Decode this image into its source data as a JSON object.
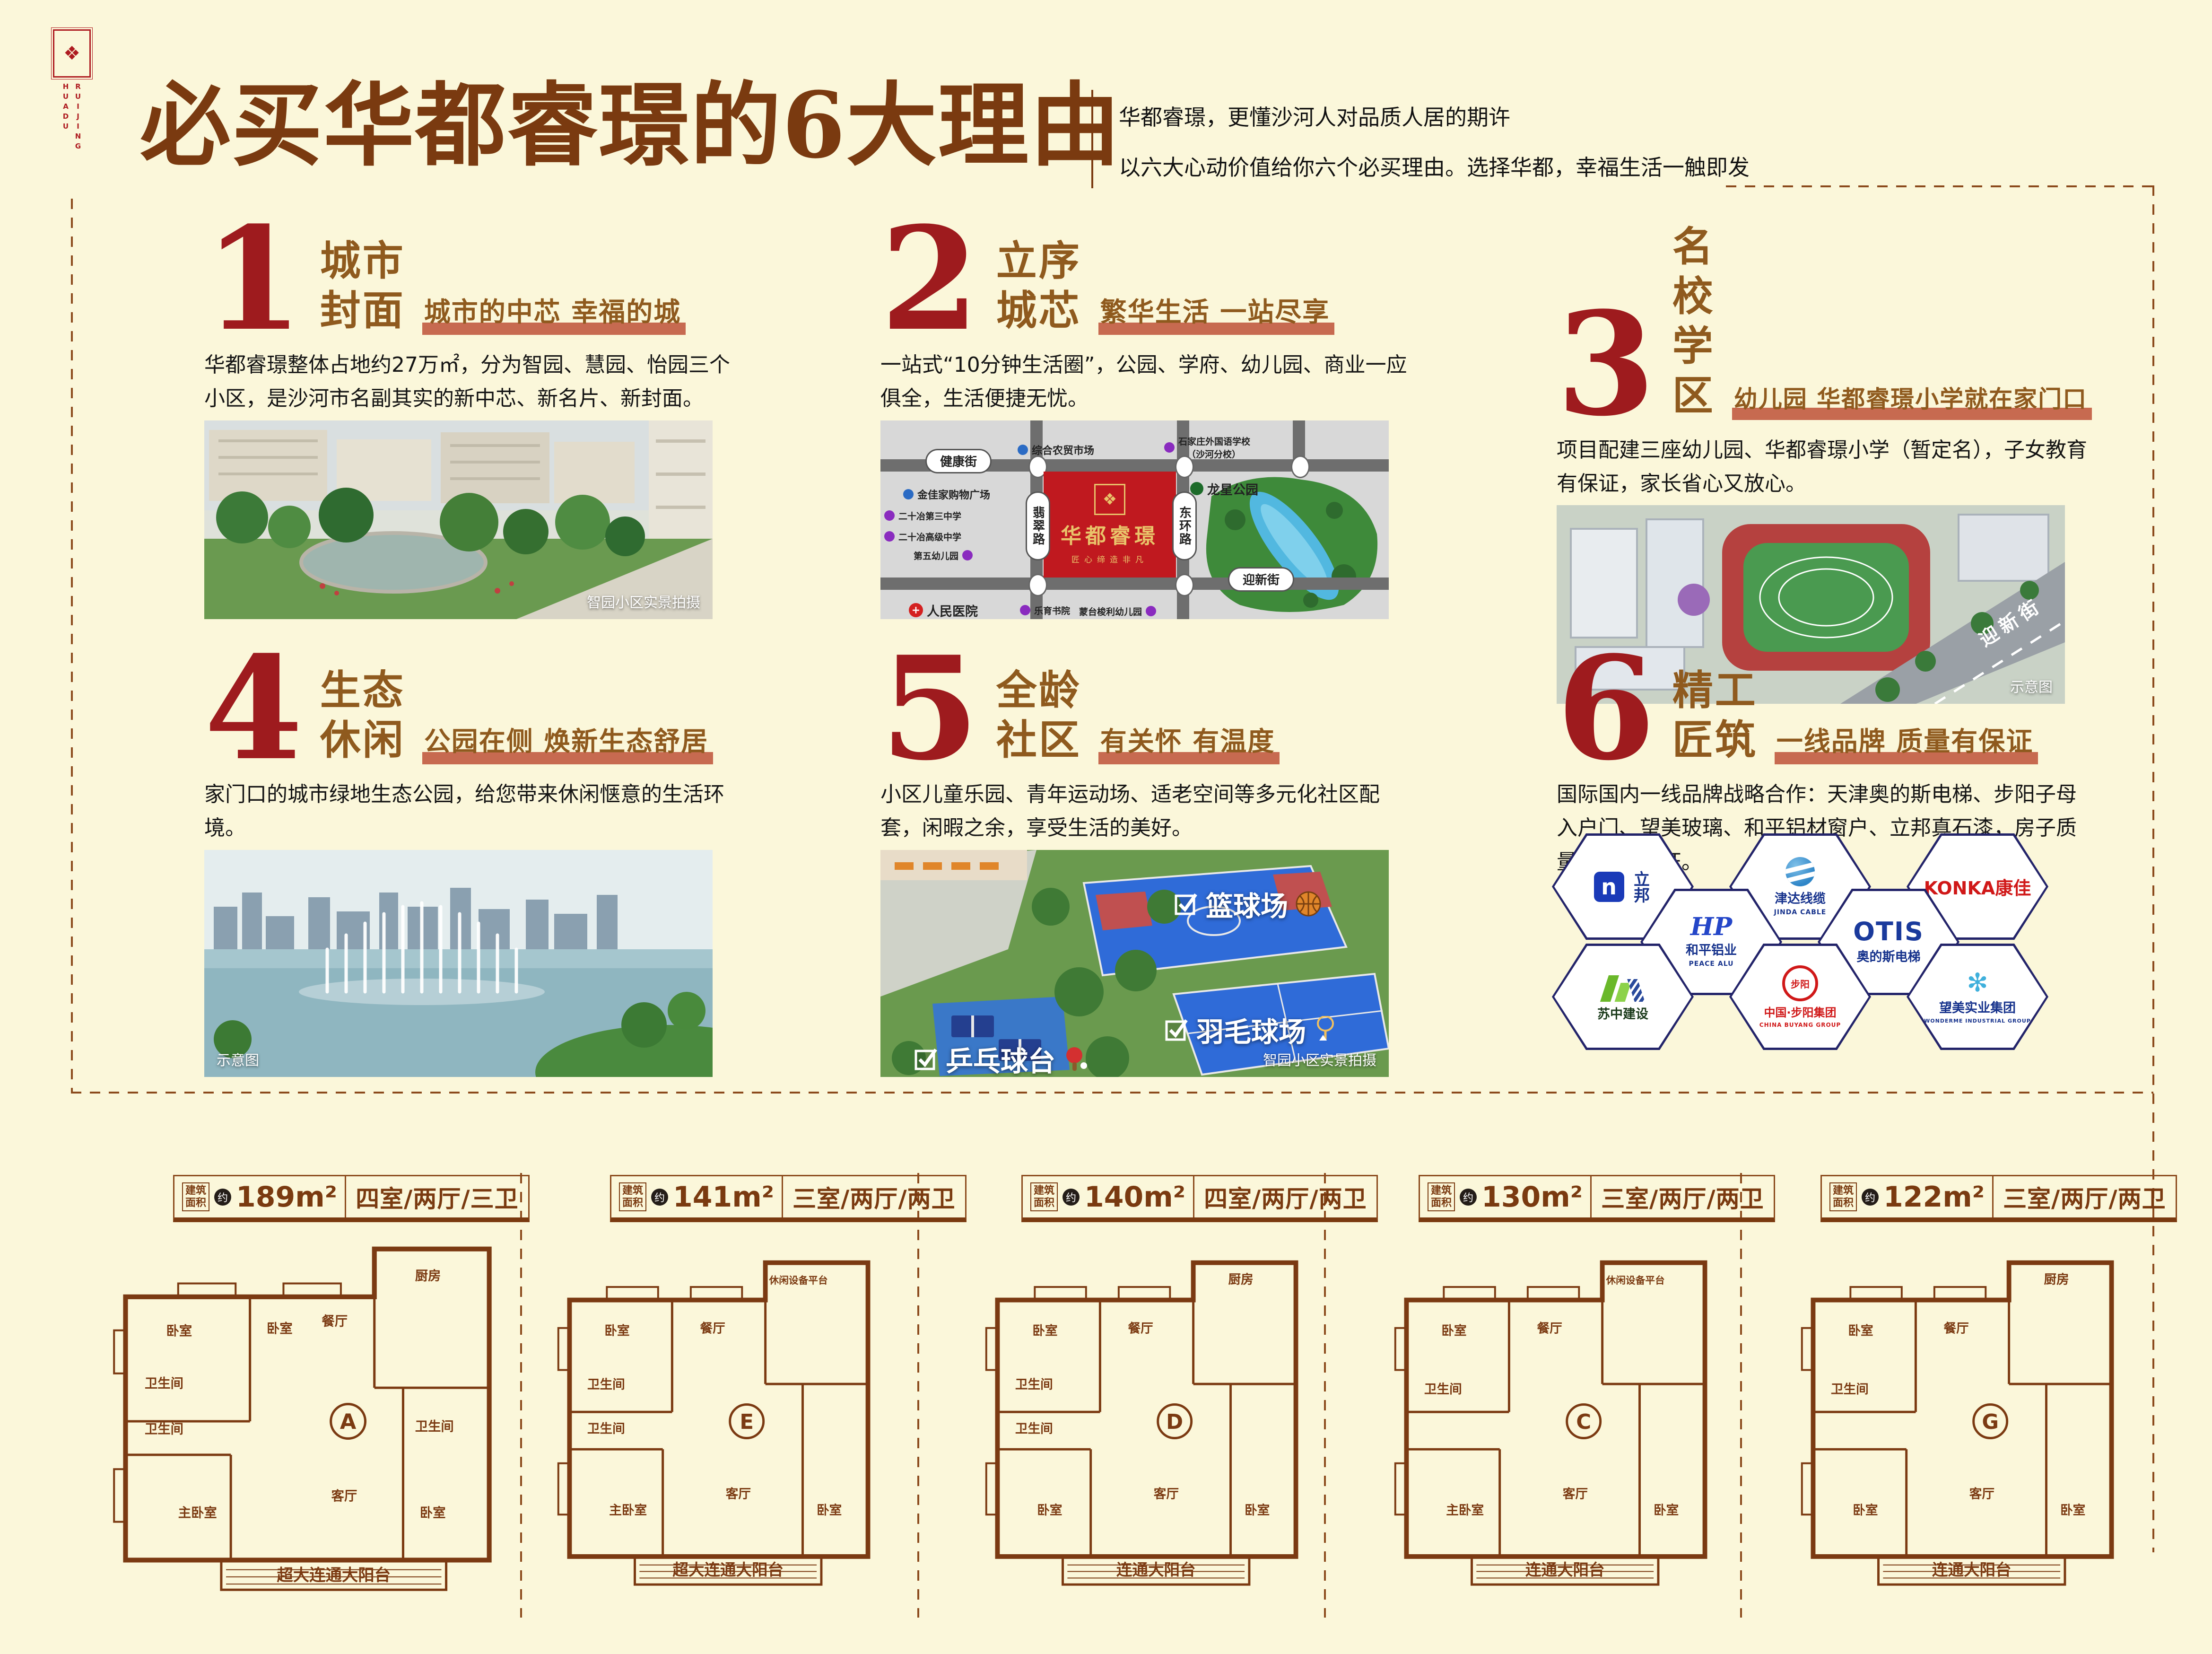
{
  "header": {
    "title": "必买华都睿璟的6大理由",
    "subtitle1": "华都睿璟，更懂沙河人对品质人居的期许",
    "subtitle2": "以六大心动价值给你六个必买理由。选择华都，幸福生活一触即发"
  },
  "logo": {
    "col1": "HUADU",
    "col2": "RUIJING",
    "flower": "❖"
  },
  "sections": [
    {
      "number": "1",
      "title1": "城市",
      "title2": "封面",
      "tagline": "城市的中芯 幸福的城",
      "body": "华都睿璟整体占地约27万㎡，分为智园、慧园、怡园三个小区，是沙河市名副其实的新中芯、新名片、新封面。",
      "caption": "智园小区实景拍摄"
    },
    {
      "number": "2",
      "title1": "立序",
      "title2": "城芯",
      "tagline": "繁华生活 一站尽享",
      "body": "一站式“10分钟生活圈”，公园、学府、幼儿园、商业一应俱全，生活便捷无忧。"
    },
    {
      "number": "3",
      "title1": "名校",
      "title2": "学区",
      "tagline": "幼儿园 华都睿璟小学就在家门口",
      "body": "项目配建三座幼儿园、华都睿璟小学（暂定名），子女教育有保证，家长省心又放心。",
      "caption": "示意图"
    },
    {
      "number": "4",
      "title1": "生态",
      "title2": "休闲",
      "tagline": "公园在侧 焕新生态舒居",
      "body": "家门口的城市绿地生态公园，给您带来休闲惬意的生活环境。",
      "caption": "示意图"
    },
    {
      "number": "5",
      "title1": "全龄",
      "title2": "社区",
      "tagline": "有关怀 有温度",
      "body": "小区儿童乐园、青年运动场、适老空间等多元化社区配套，闲暇之余，享受生活的美好。",
      "caption": "智园小区实景拍摄"
    },
    {
      "number": "6",
      "title1": "精工",
      "title2": "匠筑",
      "tagline": "一线品牌 质量有保证",
      "body": "国际国内一线品牌战略合作：天津奥的斯电梯、步阳子母入户门、望美玻璃、和平铝材窗户、立邦真石漆，房子质量无瑕有保证。"
    }
  ],
  "map": {
    "name": "华都睿璟",
    "slogan": "匠心缔造非凡",
    "emblem": "❖",
    "street_n": "健康街",
    "street_s": "迎新街",
    "street_w": "翡翠路",
    "street_e": "东环路",
    "park": "龙星公园",
    "poi1": "综合农贸市场",
    "poi2a": "石家庄外国语学校",
    "poi2b": "（沙河分校）",
    "poi3": "金佳家购物广场",
    "poi4": "二十冶第三中学",
    "poi5": "二十冶高级中学",
    "poi6": "第五幼儿园",
    "poi7": "人民医院",
    "poi8": "蒙台梭利幼儿园",
    "poi9": "乐育书院",
    "road_label": "迎新街"
  },
  "sports": {
    "item1": "篮球场",
    "item2": "羽毛球场",
    "item3": "乒乓球台"
  },
  "brands": {
    "b1": "立邦",
    "b1icon": "n",
    "b2a": "津达线缆",
    "b2b": "JINDA CABLE",
    "b3": "KONKA康佳",
    "b4a": "和平铝业",
    "b4b": "PEACE ALU",
    "b4icon": "HP",
    "b5a": "OTIS",
    "b5b": "奥的斯电梯",
    "b6": "苏中建设",
    "b7a": "中国·步阳集团",
    "b7b": "CHINA BUYANG GROUP",
    "b7icon": "步阳",
    "b8a": "望美实业集团",
    "b8b": "WONDERME INDUSTRIAL GROUP",
    "b8icon": "✻"
  },
  "plans": [
    {
      "prefix": "建筑\n面积",
      "approx": "约",
      "area": "189m²",
      "layout": "四室/两厅/三卫",
      "letter": "A",
      "balcony": "超大连通大阳台",
      "rooms": [
        "卧室",
        "卧室",
        "餐厅",
        "厨房",
        "卫生间",
        "卫生间",
        "主卧室",
        "客厅",
        "卫生间",
        "卧室"
      ]
    },
    {
      "prefix": "建筑\n面积",
      "approx": "约",
      "area": "141m²",
      "layout": "三室/两厅/两卫",
      "letter": "E",
      "balcony": "超大连通大阳台",
      "rooms": [
        "休闲设备平台",
        "卧室",
        "餐厅",
        "卫生间",
        "卫生间",
        "主卧室",
        "客厅",
        "卧室"
      ]
    },
    {
      "prefix": "建筑\n面积",
      "approx": "约",
      "area": "140m²",
      "layout": "四室/两厅/两卫",
      "letter": "D",
      "balcony": "连通大阳台",
      "rooms": [
        "厨房",
        "卧室",
        "餐厅",
        "卫生间",
        "卫生间",
        "卧室",
        "客厅",
        "卧室"
      ]
    },
    {
      "prefix": "建筑\n面积",
      "approx": "约",
      "area": "130m²",
      "layout": "三室/两厅/两卫",
      "letter": "C",
      "balcony": "连通大阳台",
      "rooms": [
        "休闲设备平台",
        "卧室",
        "餐厅",
        "卫生间",
        "主卧室",
        "客厅",
        "卧室"
      ]
    },
    {
      "prefix": "建筑\n面积",
      "approx": "约",
      "area": "122m²",
      "layout": "三室/两厅/两卫",
      "letter": "G",
      "balcony": "连通大阳台",
      "rooms": [
        "厨房",
        "卧室",
        "餐厅",
        "卫生间",
        "卧室",
        "客厅",
        "卧室"
      ]
    }
  ]
}
